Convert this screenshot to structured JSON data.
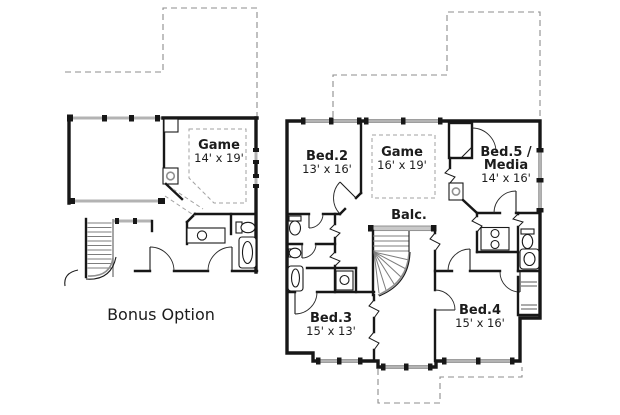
{
  "document": {
    "type": "floor-plan-drawing",
    "background": "#ffffff"
  },
  "colors": {
    "wall": "#171717",
    "window_gray": "#b3b3b3",
    "roof_dash": "#8c8c8c",
    "text": "#1c1c1c"
  },
  "bonus_plan": {
    "caption": "Bonus Option",
    "rooms": {
      "game": {
        "name": "Game",
        "dims": "14' x 19'"
      }
    }
  },
  "main_plan": {
    "rooms": {
      "bed2": {
        "name": "Bed.2",
        "dims": "13' x 16'"
      },
      "game": {
        "name": "Game",
        "dims": "16' x 19'"
      },
      "bed5": {
        "name": "Bed.5 /",
        "name_line2": "Media",
        "dims": "14' x 16'"
      },
      "balcony": {
        "name": "Balc."
      },
      "bed3": {
        "name": "Bed.3",
        "dims": "15' x 13'"
      },
      "bed4": {
        "name": "Bed.4",
        "dims": "15' x 16'"
      }
    }
  }
}
